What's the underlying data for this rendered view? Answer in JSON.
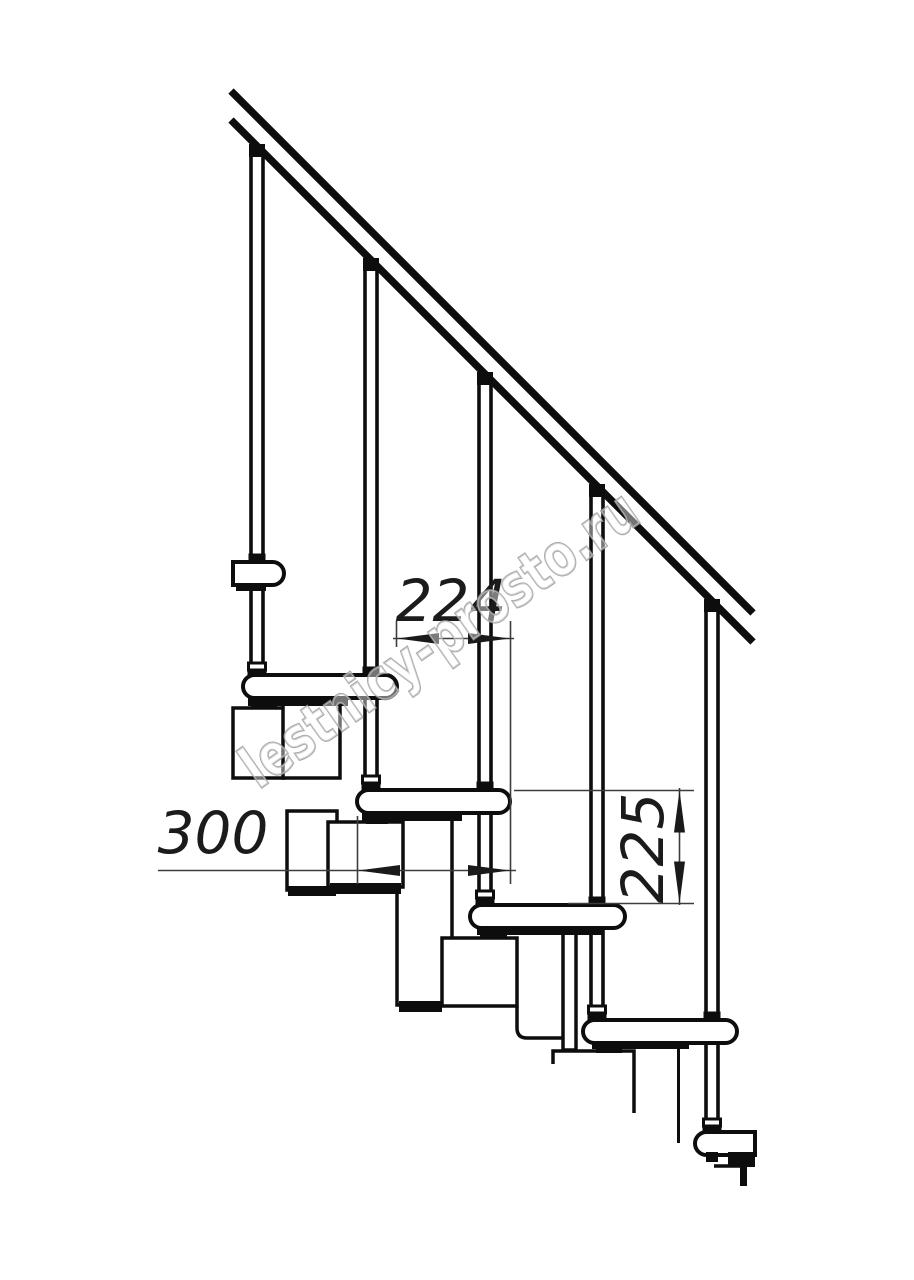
{
  "page": {
    "width": 914,
    "height": 1280,
    "background": "#ffffff"
  },
  "watermark": {
    "text": "lestnicy-prosto.ru",
    "color": "#9a9a9a"
  },
  "annotations": {
    "dim_224": "224",
    "dim_300": "300",
    "dim_225": "225"
  },
  "drawing": {
    "stroke": "#0d0d0d",
    "dim_stroke": "#3d3d3d",
    "dim_text_color": "#1b1b1b",
    "handrail": {
      "width": 7.5,
      "lines": [
        [
          231,
          91,
          753,
          613
        ],
        [
          231,
          120,
          753,
          642
        ]
      ]
    },
    "balusters": [
      {
        "cx": 257,
        "rail_y": 146,
        "stand_y": 677,
        "cross_y": 562
      },
      {
        "cx": 371,
        "rail_y": 260,
        "stand_y": 790,
        "cross_y": 675
      },
      {
        "cx": 485,
        "rail_y": 374,
        "stand_y": 905,
        "cross_y": 790
      },
      {
        "cx": 597,
        "rail_y": 486,
        "stand_y": 1020,
        "cross_y": 905
      },
      {
        "cx": 712,
        "rail_y": 601,
        "stand_y": 1133,
        "cross_y": 1020
      }
    ],
    "treads": [
      {
        "name": "tread-a",
        "type": "cut-left",
        "x1": 233,
        "x2": 284,
        "y": 562,
        "h": 23
      },
      {
        "name": "tread-b",
        "type": "stadium",
        "x1": 243,
        "x2": 397,
        "y": 675,
        "h": 23
      },
      {
        "name": "tread-c",
        "type": "stadium",
        "x1": 357,
        "x2": 510,
        "y": 790,
        "h": 23
      },
      {
        "name": "tread-d",
        "type": "stadium",
        "x1": 470,
        "x2": 625,
        "y": 905,
        "h": 23
      },
      {
        "name": "tread-e",
        "type": "stadium",
        "x1": 583,
        "x2": 737,
        "y": 1020,
        "h": 23
      },
      {
        "name": "tread-f",
        "type": "cut-right",
        "x1": 695,
        "x2": 755,
        "y": 1132,
        "h": 23
      }
    ],
    "underside_marks": [
      [
        236,
        584,
        30,
        7
      ],
      [
        248,
        697,
        100,
        9
      ],
      [
        251,
        699,
        26,
        10
      ],
      [
        362,
        812,
        100,
        9
      ],
      [
        366,
        814,
        22,
        10
      ],
      [
        477,
        927,
        126,
        8
      ],
      [
        480,
        929,
        27,
        10
      ],
      [
        592,
        1041,
        97,
        8
      ],
      [
        596,
        1043,
        26,
        10
      ],
      [
        706,
        1152,
        12,
        10
      ],
      [
        728,
        1152,
        27,
        15
      ]
    ],
    "modules": [
      [
        233,
        708,
        51,
        70
      ],
      [
        283,
        700,
        57,
        78
      ],
      [
        287,
        811,
        50,
        79
      ],
      [
        397,
        816,
        55,
        189
      ],
      [
        328,
        822,
        75,
        65
      ],
      [
        442,
        938,
        75,
        68
      ],
      [
        563,
        928,
        13,
        122
      ]
    ],
    "module_blacks": [
      [
        288,
        886,
        48,
        10
      ],
      [
        399,
        1001,
        43,
        11
      ],
      [
        330,
        883,
        71,
        11
      ],
      [
        740,
        1166,
        7,
        20
      ]
    ],
    "module_paths": [
      "M 517 1006 L 517 1028 Q 517 1038 527 1038 L 563 1038",
      "M 553 1064 L 553 1051 L 634 1051 L 634 1113",
      "M 714 1166 L 744 1166"
    ],
    "module_lines": [
      [
        678.5,
        1045,
        678.5,
        1143
      ]
    ],
    "dims": {
      "lines": [
        [
          393,
          638.5,
          514,
          638.5
        ],
        [
          158,
          870.5,
          516,
          870.5
        ],
        [
          679.5,
          788,
          679.5,
          905
        ]
      ],
      "exts": [
        [
          396.5,
          621,
          396.5,
          647
        ],
        [
          510.5,
          621,
          510.5,
          884
        ],
        [
          357.5,
          816,
          357.5,
          884
        ],
        [
          514,
          790.5,
          694,
          790.5
        ],
        [
          568,
          903.5,
          694,
          903.5
        ]
      ],
      "arrows": [
        {
          "x": 397,
          "y": 638.5,
          "a": 180
        },
        {
          "x": 510,
          "y": 638.5,
          "a": 0
        },
        {
          "x": 358,
          "y": 870.5,
          "a": 180
        },
        {
          "x": 510,
          "y": 870.5,
          "a": 0
        },
        {
          "x": 679.5,
          "y": 790.5,
          "a": -90
        },
        {
          "x": 679.5,
          "y": 903.5,
          "a": 90
        }
      ]
    }
  }
}
